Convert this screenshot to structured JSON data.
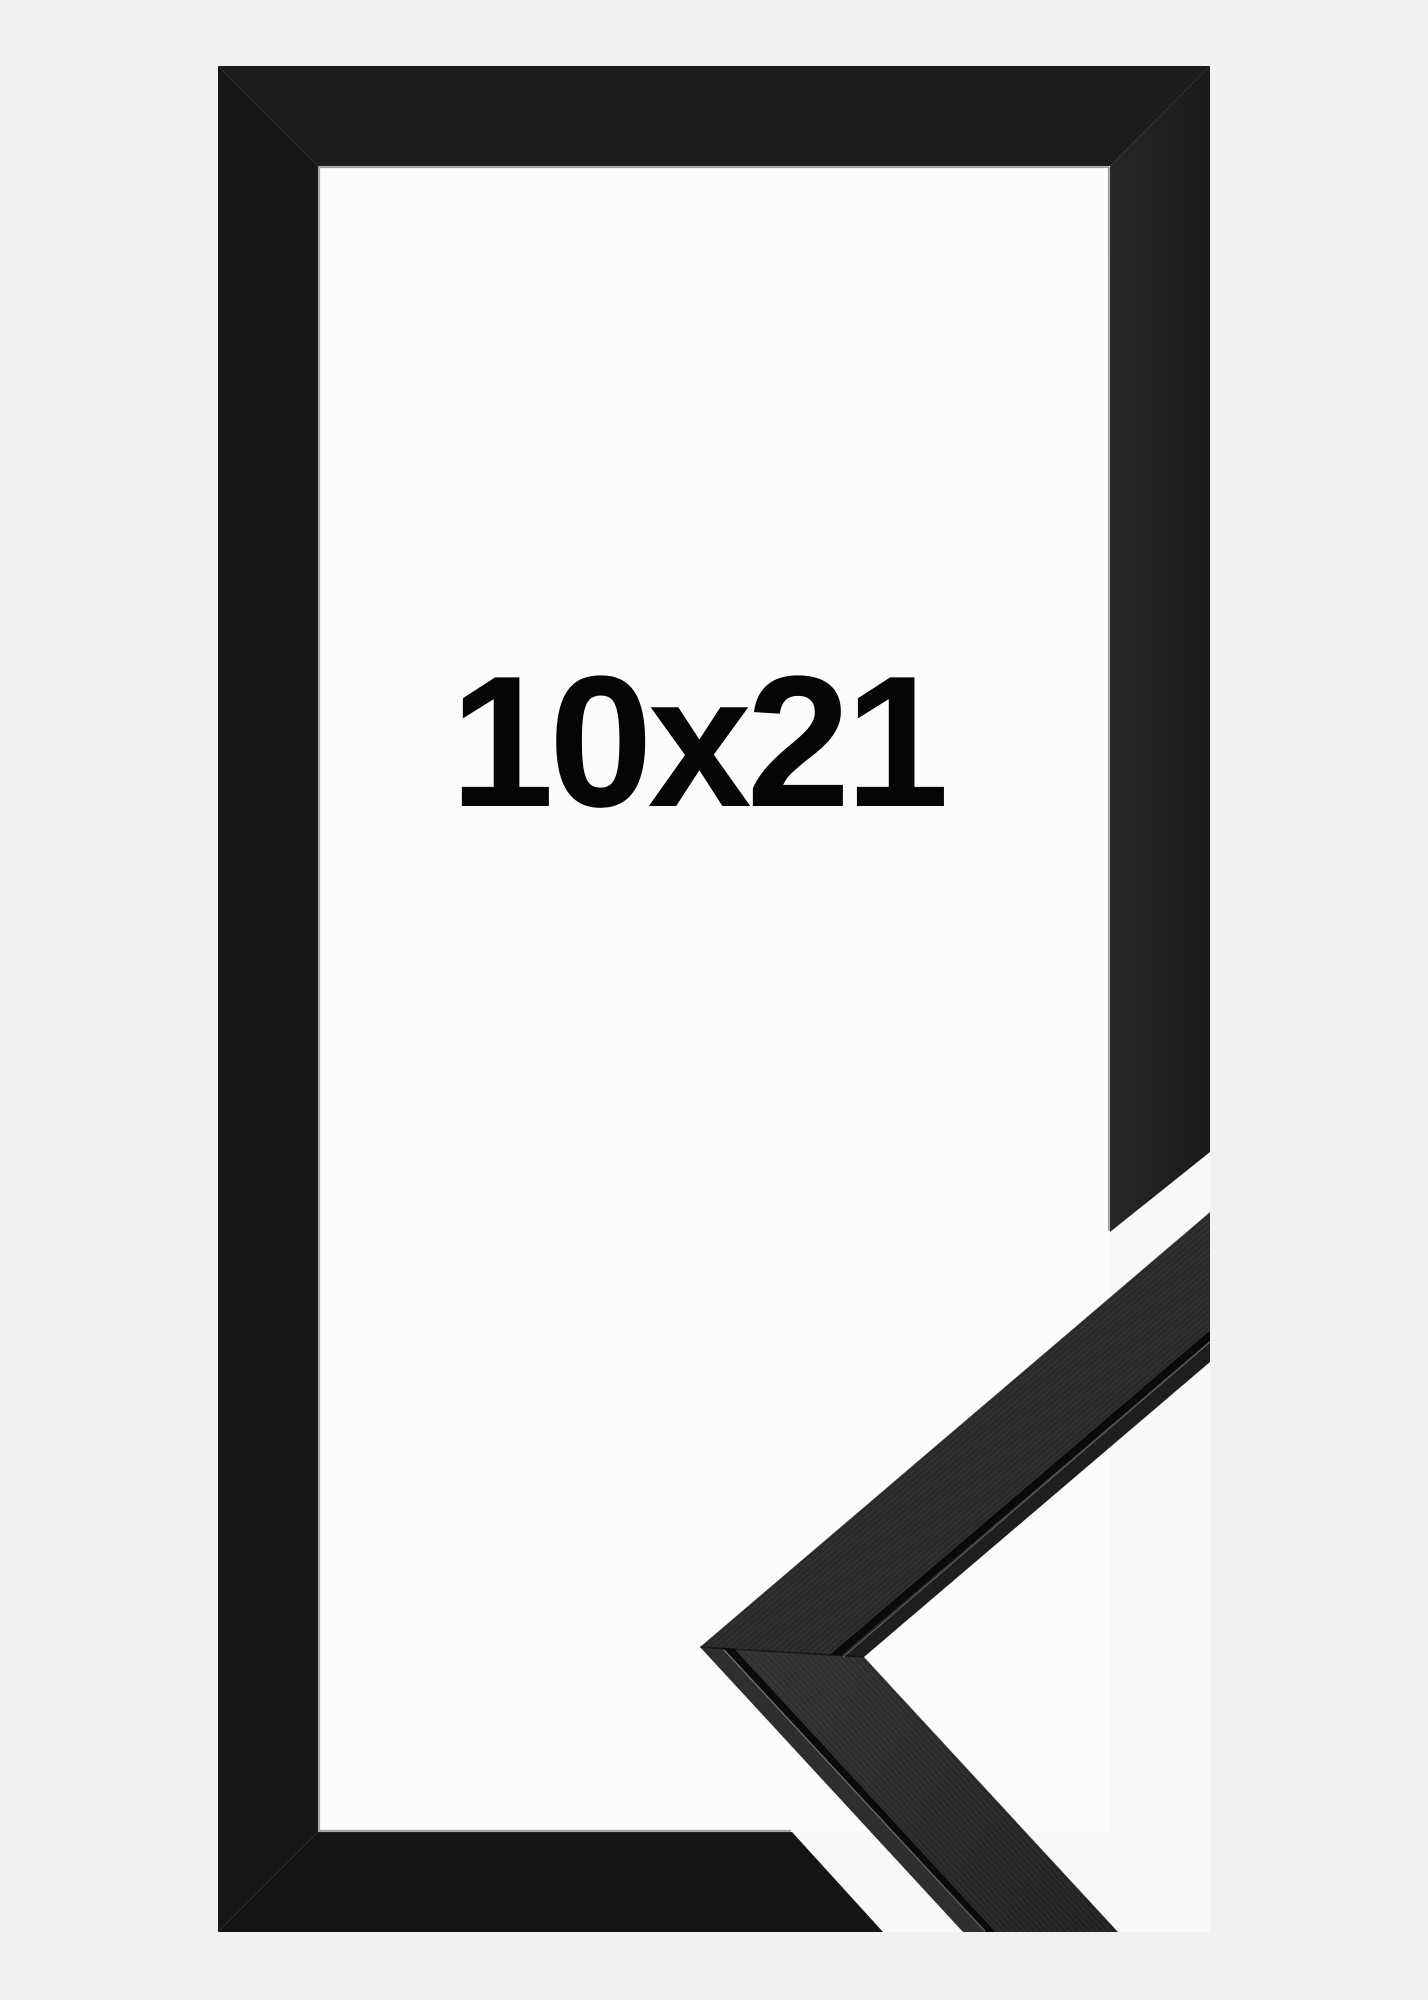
{
  "product_image": {
    "size_label": "10x21",
    "subject": "black-wood-picture-frame-with-corner-profile-sample"
  },
  "colors": {
    "background": "#f1f1f2",
    "backdrop": "#f8f8f8",
    "opening": "#fcfcfc",
    "frame_top": "#1c1c1c",
    "frame_left": "#171717",
    "frame_bottom": "#141414",
    "frame_right_inner": "#272727",
    "frame_right_outer": "#191919",
    "bevel_line": "#8f8f8f",
    "sample_face_upper": "#292929",
    "sample_face_lower_near": "#313131",
    "sample_face_lower_far": "#212121",
    "sample_groove": "#0a0a0a",
    "sample_lip_upper": "#1e1e1e",
    "sample_lip_lower": "#2e2e2e",
    "label_text": "#050505"
  }
}
